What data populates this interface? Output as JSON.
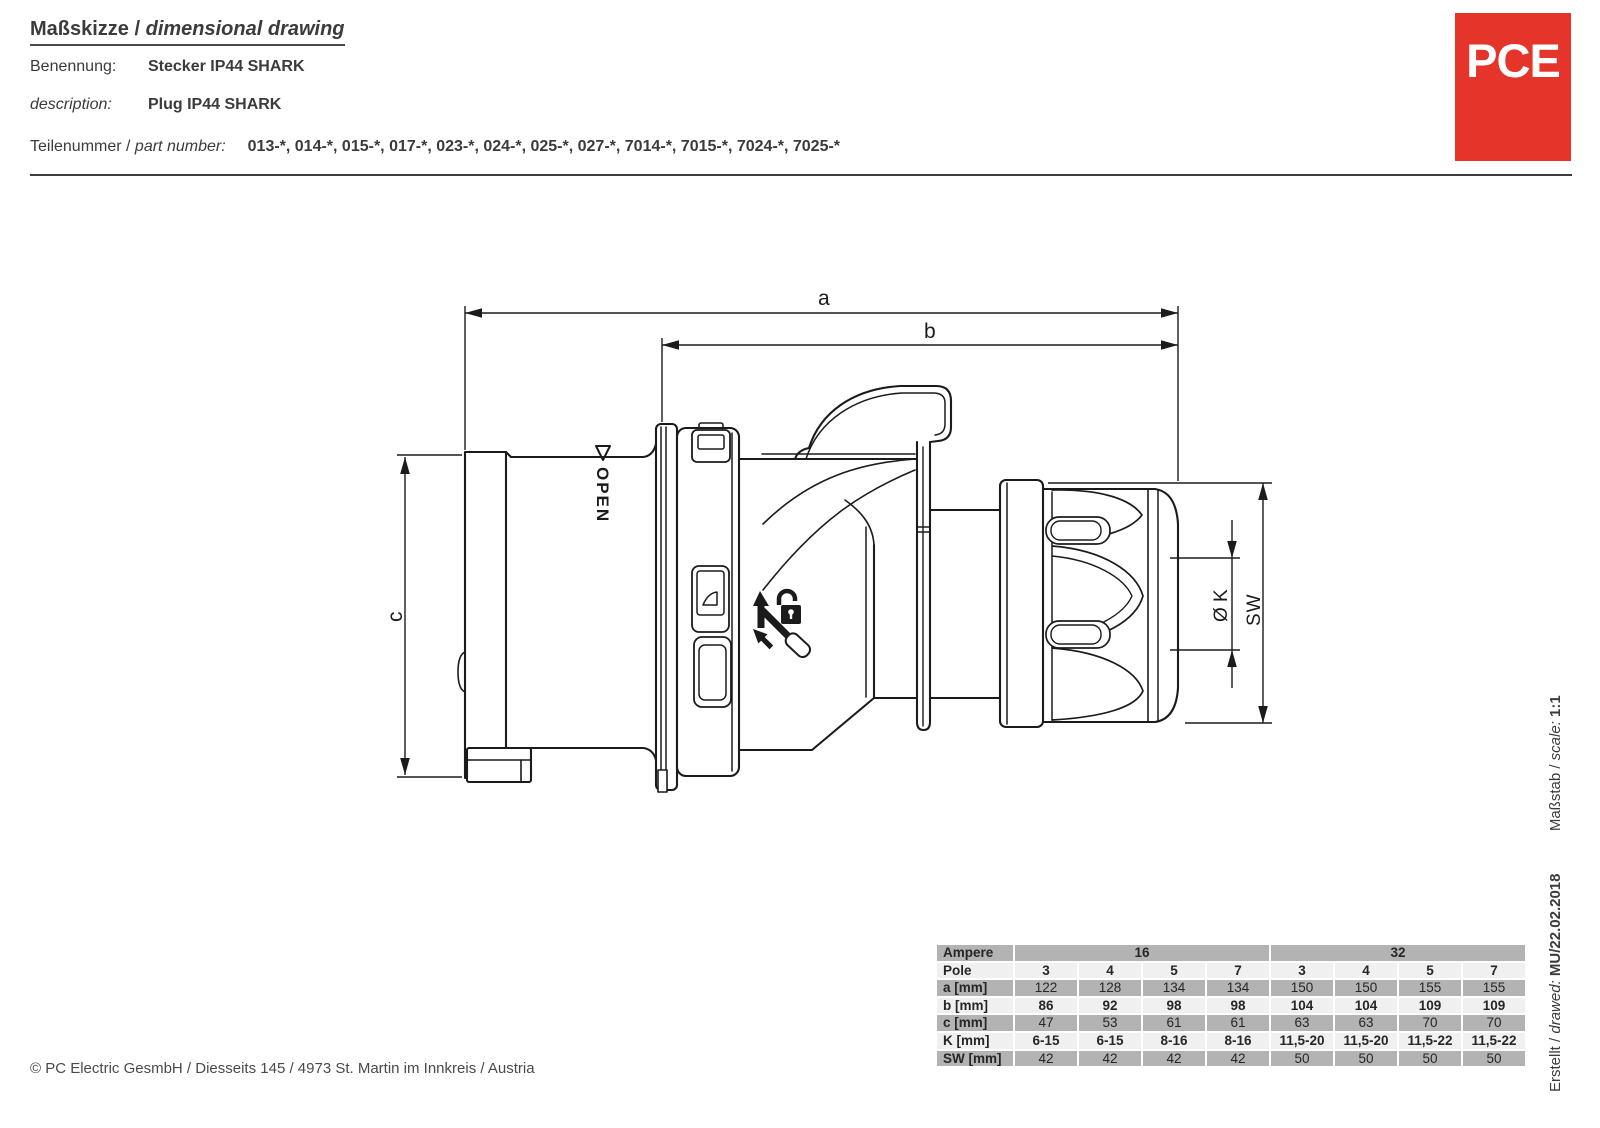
{
  "header": {
    "title_de": "Maßskizze",
    "title_sep": " / ",
    "title_en": "dimensional drawing",
    "benennung_label": "Benennung:",
    "benennung_value": "Stecker IP44 SHARK",
    "description_label": "description:",
    "description_value": "Plug IP44 SHARK",
    "partnumber_label_de": "Teilenummer / ",
    "partnumber_label_en": "part number:",
    "partnumber_value": "013-*, 014-*, 015-*, 017-*, 023-*, 024-*, 025-*, 027-*, 7014-*, 7015-*, 7024-*, 7025-*"
  },
  "logo": {
    "text": "PCE",
    "color": "#e5342a"
  },
  "drawing": {
    "dim_a": "a",
    "dim_b": "b",
    "dim_c": "c",
    "dim_k": "Ø K",
    "dim_sw": "SW",
    "open_label": "OPEN"
  },
  "table": {
    "ampere_label": "Ampere",
    "ampere_16": "16",
    "ampere_32": "32",
    "rows": [
      {
        "label": "Pole",
        "values": [
          "3",
          "4",
          "5",
          "7",
          "3",
          "4",
          "5",
          "7"
        ]
      },
      {
        "label": "a [mm]",
        "values": [
          "122",
          "128",
          "134",
          "134",
          "150",
          "150",
          "155",
          "155"
        ]
      },
      {
        "label": "b [mm]",
        "values": [
          "86",
          "92",
          "98",
          "98",
          "104",
          "104",
          "109",
          "109"
        ]
      },
      {
        "label": "c [mm]",
        "values": [
          "47",
          "53",
          "61",
          "61",
          "63",
          "63",
          "70",
          "70"
        ]
      },
      {
        "label": "K [mm]",
        "values": [
          "6-15",
          "6-15",
          "8-16",
          "8-16",
          "11,5-20",
          "11,5-20",
          "11,5-22",
          "11,5-22"
        ]
      },
      {
        "label": "SW [mm]",
        "values": [
          "42",
          "42",
          "42",
          "42",
          "50",
          "50",
          "50",
          "50"
        ]
      }
    ]
  },
  "sidebar": {
    "created_label": "Erstellt / ",
    "created_label_en": "drawed:",
    "created_value": "MU/22.02.2018",
    "scale_label": "Maßstab / ",
    "scale_label_en": "scale:",
    "scale_value": "1:1"
  },
  "footer": {
    "copyright": "© PC Electric GesmbH / Diesseits 145 / 4973 St. Martin im Innkreis / Austria"
  }
}
